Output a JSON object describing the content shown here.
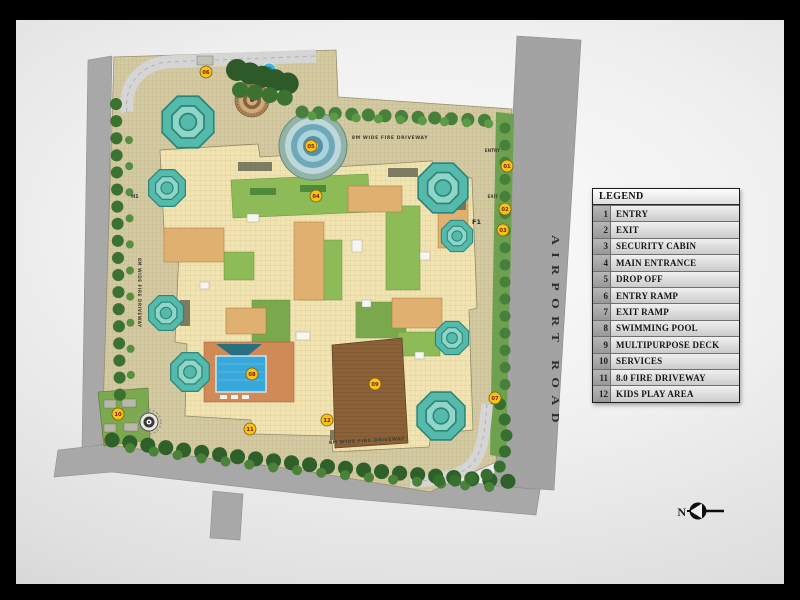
{
  "window": {
    "frame_color": "#000000",
    "slide_bg": "#ededed"
  },
  "plan": {
    "labels": {
      "fire_driveway": "8M WIDE FIRE DRIVEWAY",
      "entry": "ENTRY",
      "exit": "EXIT",
      "block_f1": "F1",
      "block_h1": "H1",
      "airport_road": "AIRPORT ROAD"
    },
    "markers": [
      {
        "num": "01",
        "name": "entry"
      },
      {
        "num": "02",
        "name": "exit"
      },
      {
        "num": "03",
        "name": "security-cabin"
      },
      {
        "num": "04",
        "name": "main-entrance"
      },
      {
        "num": "05",
        "name": "drop-off"
      },
      {
        "num": "06",
        "name": "entry-ramp"
      },
      {
        "num": "07",
        "name": "exit-ramp"
      },
      {
        "num": "08",
        "name": "swimming-pool"
      },
      {
        "num": "09",
        "name": "multipurpose-deck"
      },
      {
        "num": "10",
        "name": "services"
      },
      {
        "num": "11",
        "name": "fire-driveway"
      },
      {
        "num": "12",
        "name": "kids-play-area"
      }
    ]
  },
  "legend": {
    "title": "LEGEND",
    "items": [
      {
        "num": "1",
        "label": "ENTRY"
      },
      {
        "num": "2",
        "label": "EXIT"
      },
      {
        "num": "3",
        "label": "SECURITY CABIN"
      },
      {
        "num": "4",
        "label": "MAIN ENTRANCE"
      },
      {
        "num": "5",
        "label": "DROP OFF"
      },
      {
        "num": "6",
        "label": "ENTRY RAMP"
      },
      {
        "num": "7",
        "label": "EXIT RAMP"
      },
      {
        "num": "8",
        "label": "SWIMMING POOL"
      },
      {
        "num": "9",
        "label": "MULTIPURPOSE DECK"
      },
      {
        "num": "10",
        "label": "SERVICES"
      },
      {
        "num": "11",
        "label": "8.0 FIRE DRIVEWAY"
      },
      {
        "num": "12",
        "label": "KIDS PLAY AREA"
      }
    ]
  },
  "compass": {
    "north_label": "N"
  },
  "colors": {
    "marker_yellow": "#f4c21b",
    "tower_teal": "#55b9ab",
    "pool_blue": "#38a7d9",
    "deck_brown": "#8c6138",
    "roof_cream": "#f1e4b2",
    "paving_tan": "#d4caa2",
    "landscape_green": "#6da14f",
    "road_gray": "#a8a8a8"
  }
}
